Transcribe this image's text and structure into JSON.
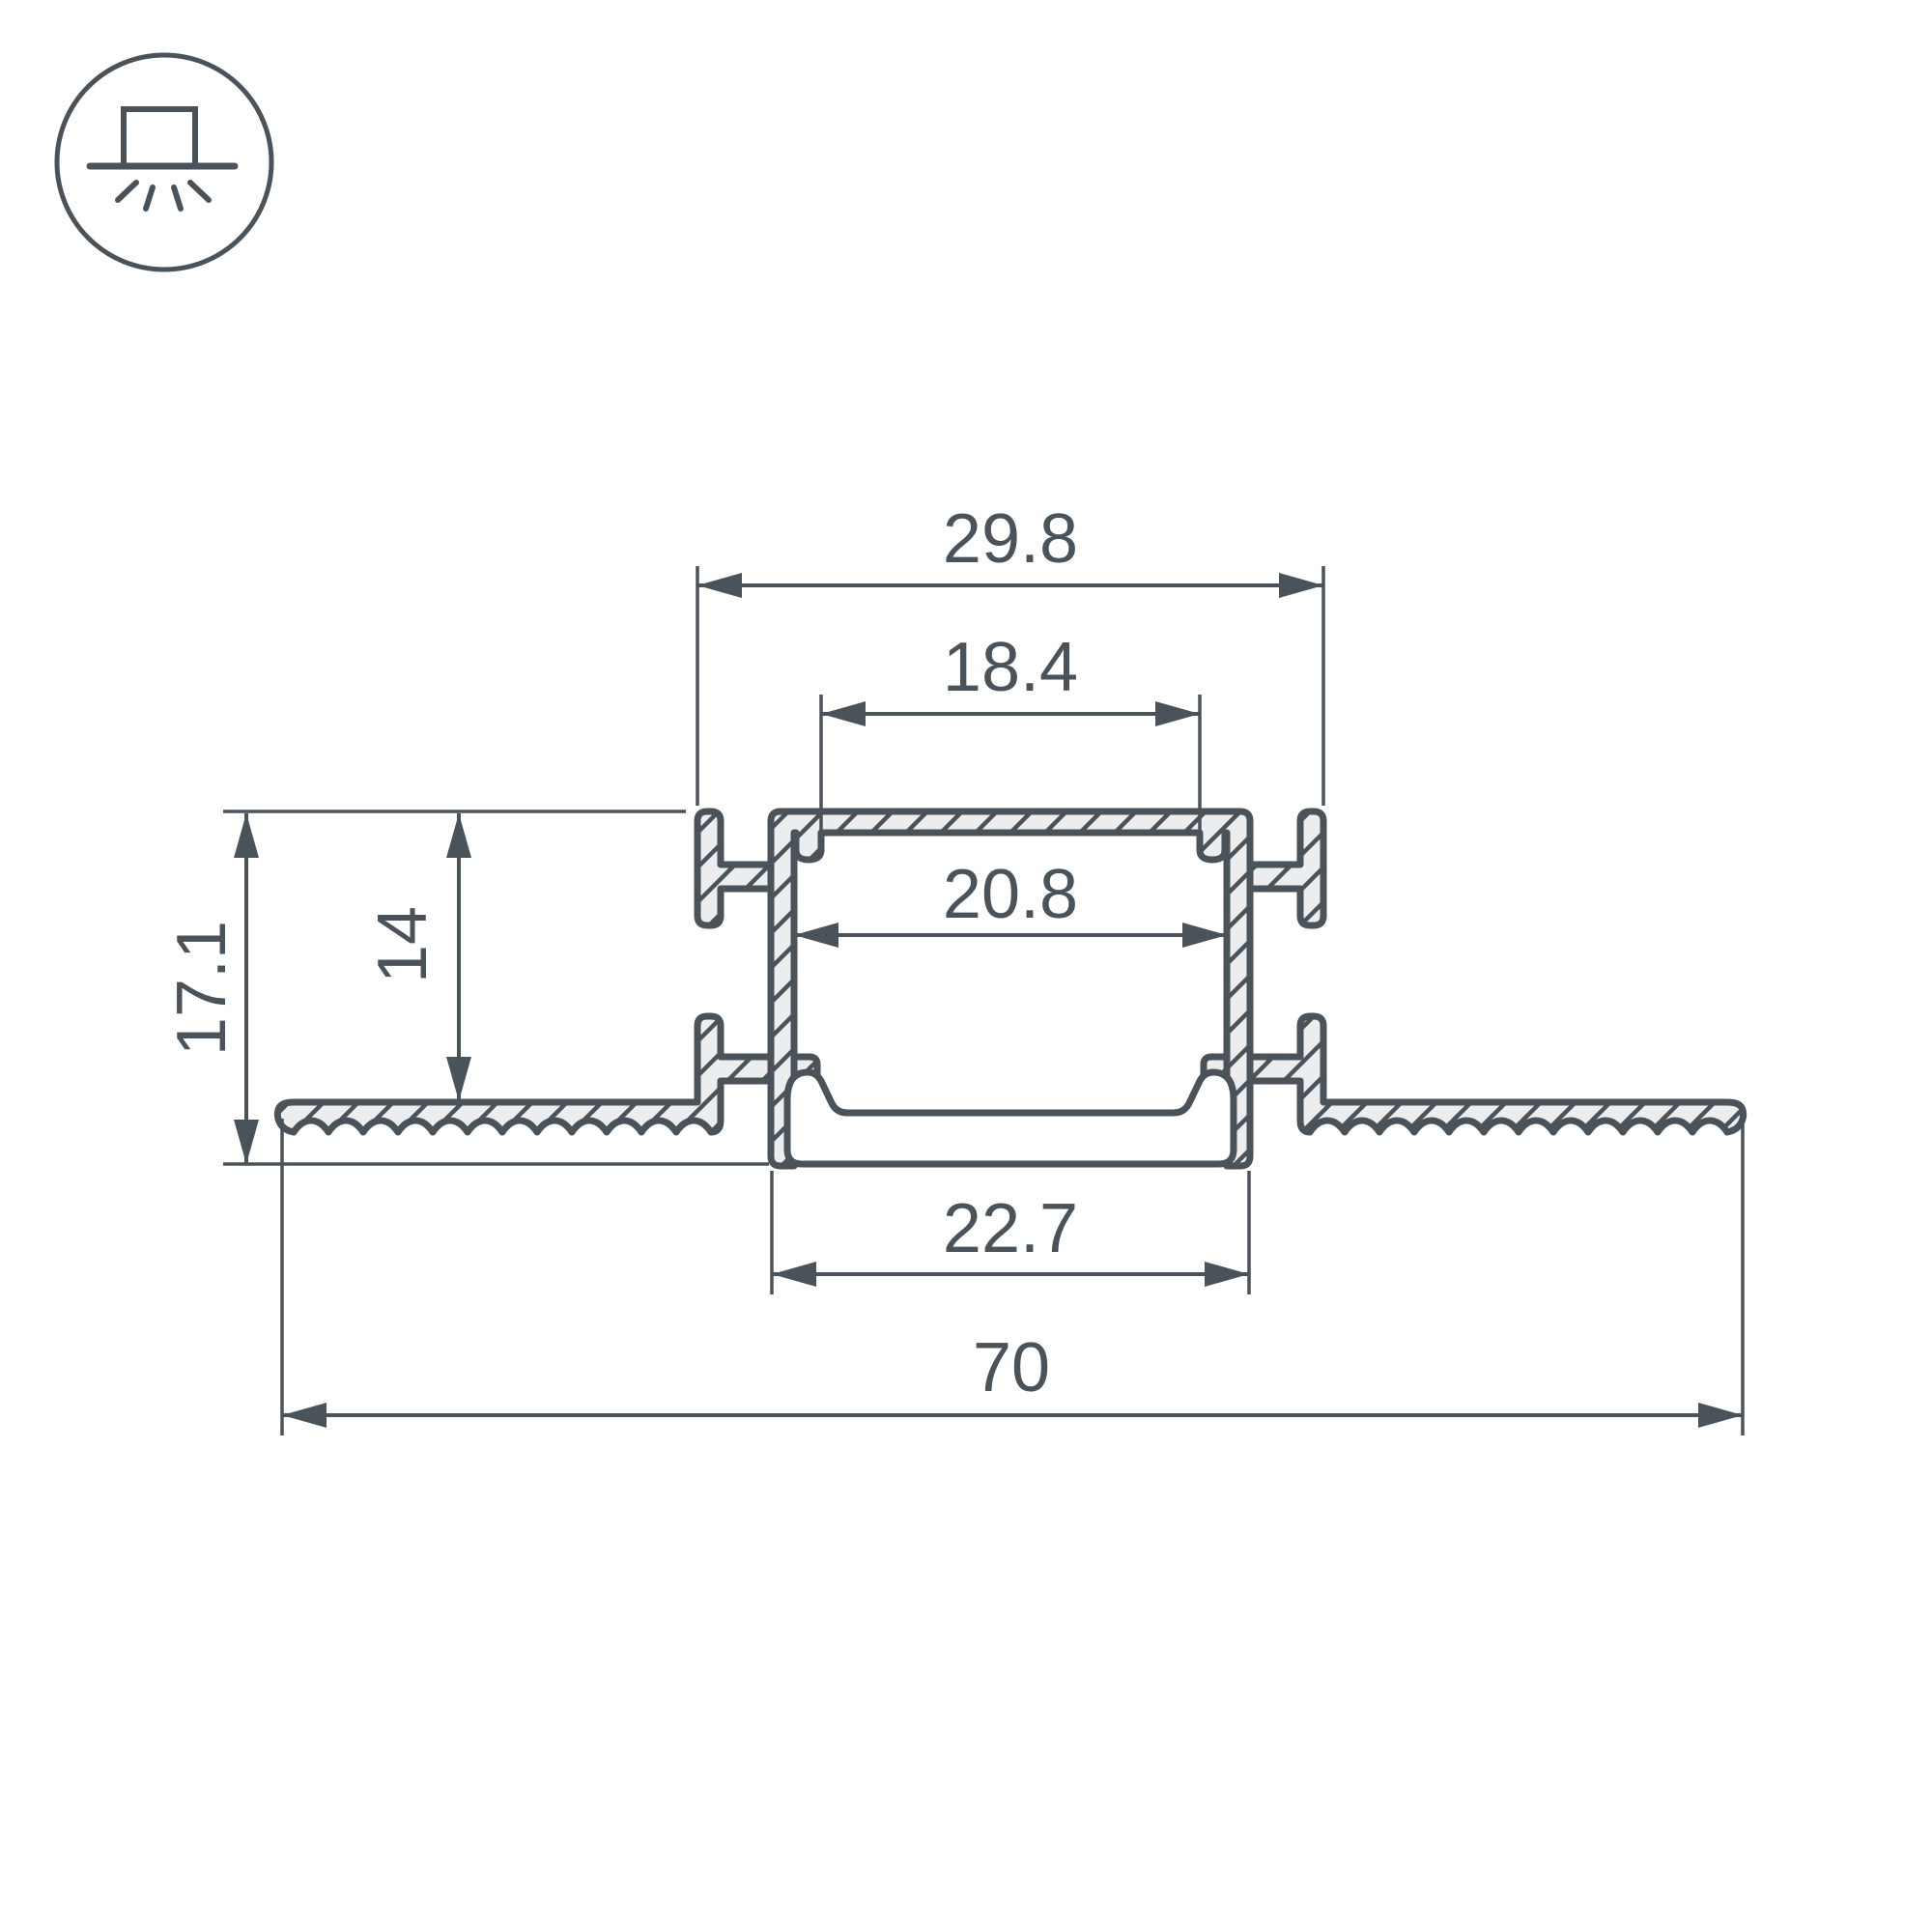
{
  "drawing": {
    "type": "led-profile-cross-section-technical-drawing",
    "colors": {
      "line": "#4A525A",
      "metal_fill": "#ECEDEE",
      "background": "#FFFFFF"
    },
    "icon": {
      "name": "recessed-mount-light-icon"
    },
    "labels": {
      "outer_width": "29.8",
      "opening_width": "18.4",
      "inner_width": "20.8",
      "bottom_width": "22.7",
      "total_width": "70",
      "total_height": "17.1",
      "mount_depth": "14"
    }
  }
}
